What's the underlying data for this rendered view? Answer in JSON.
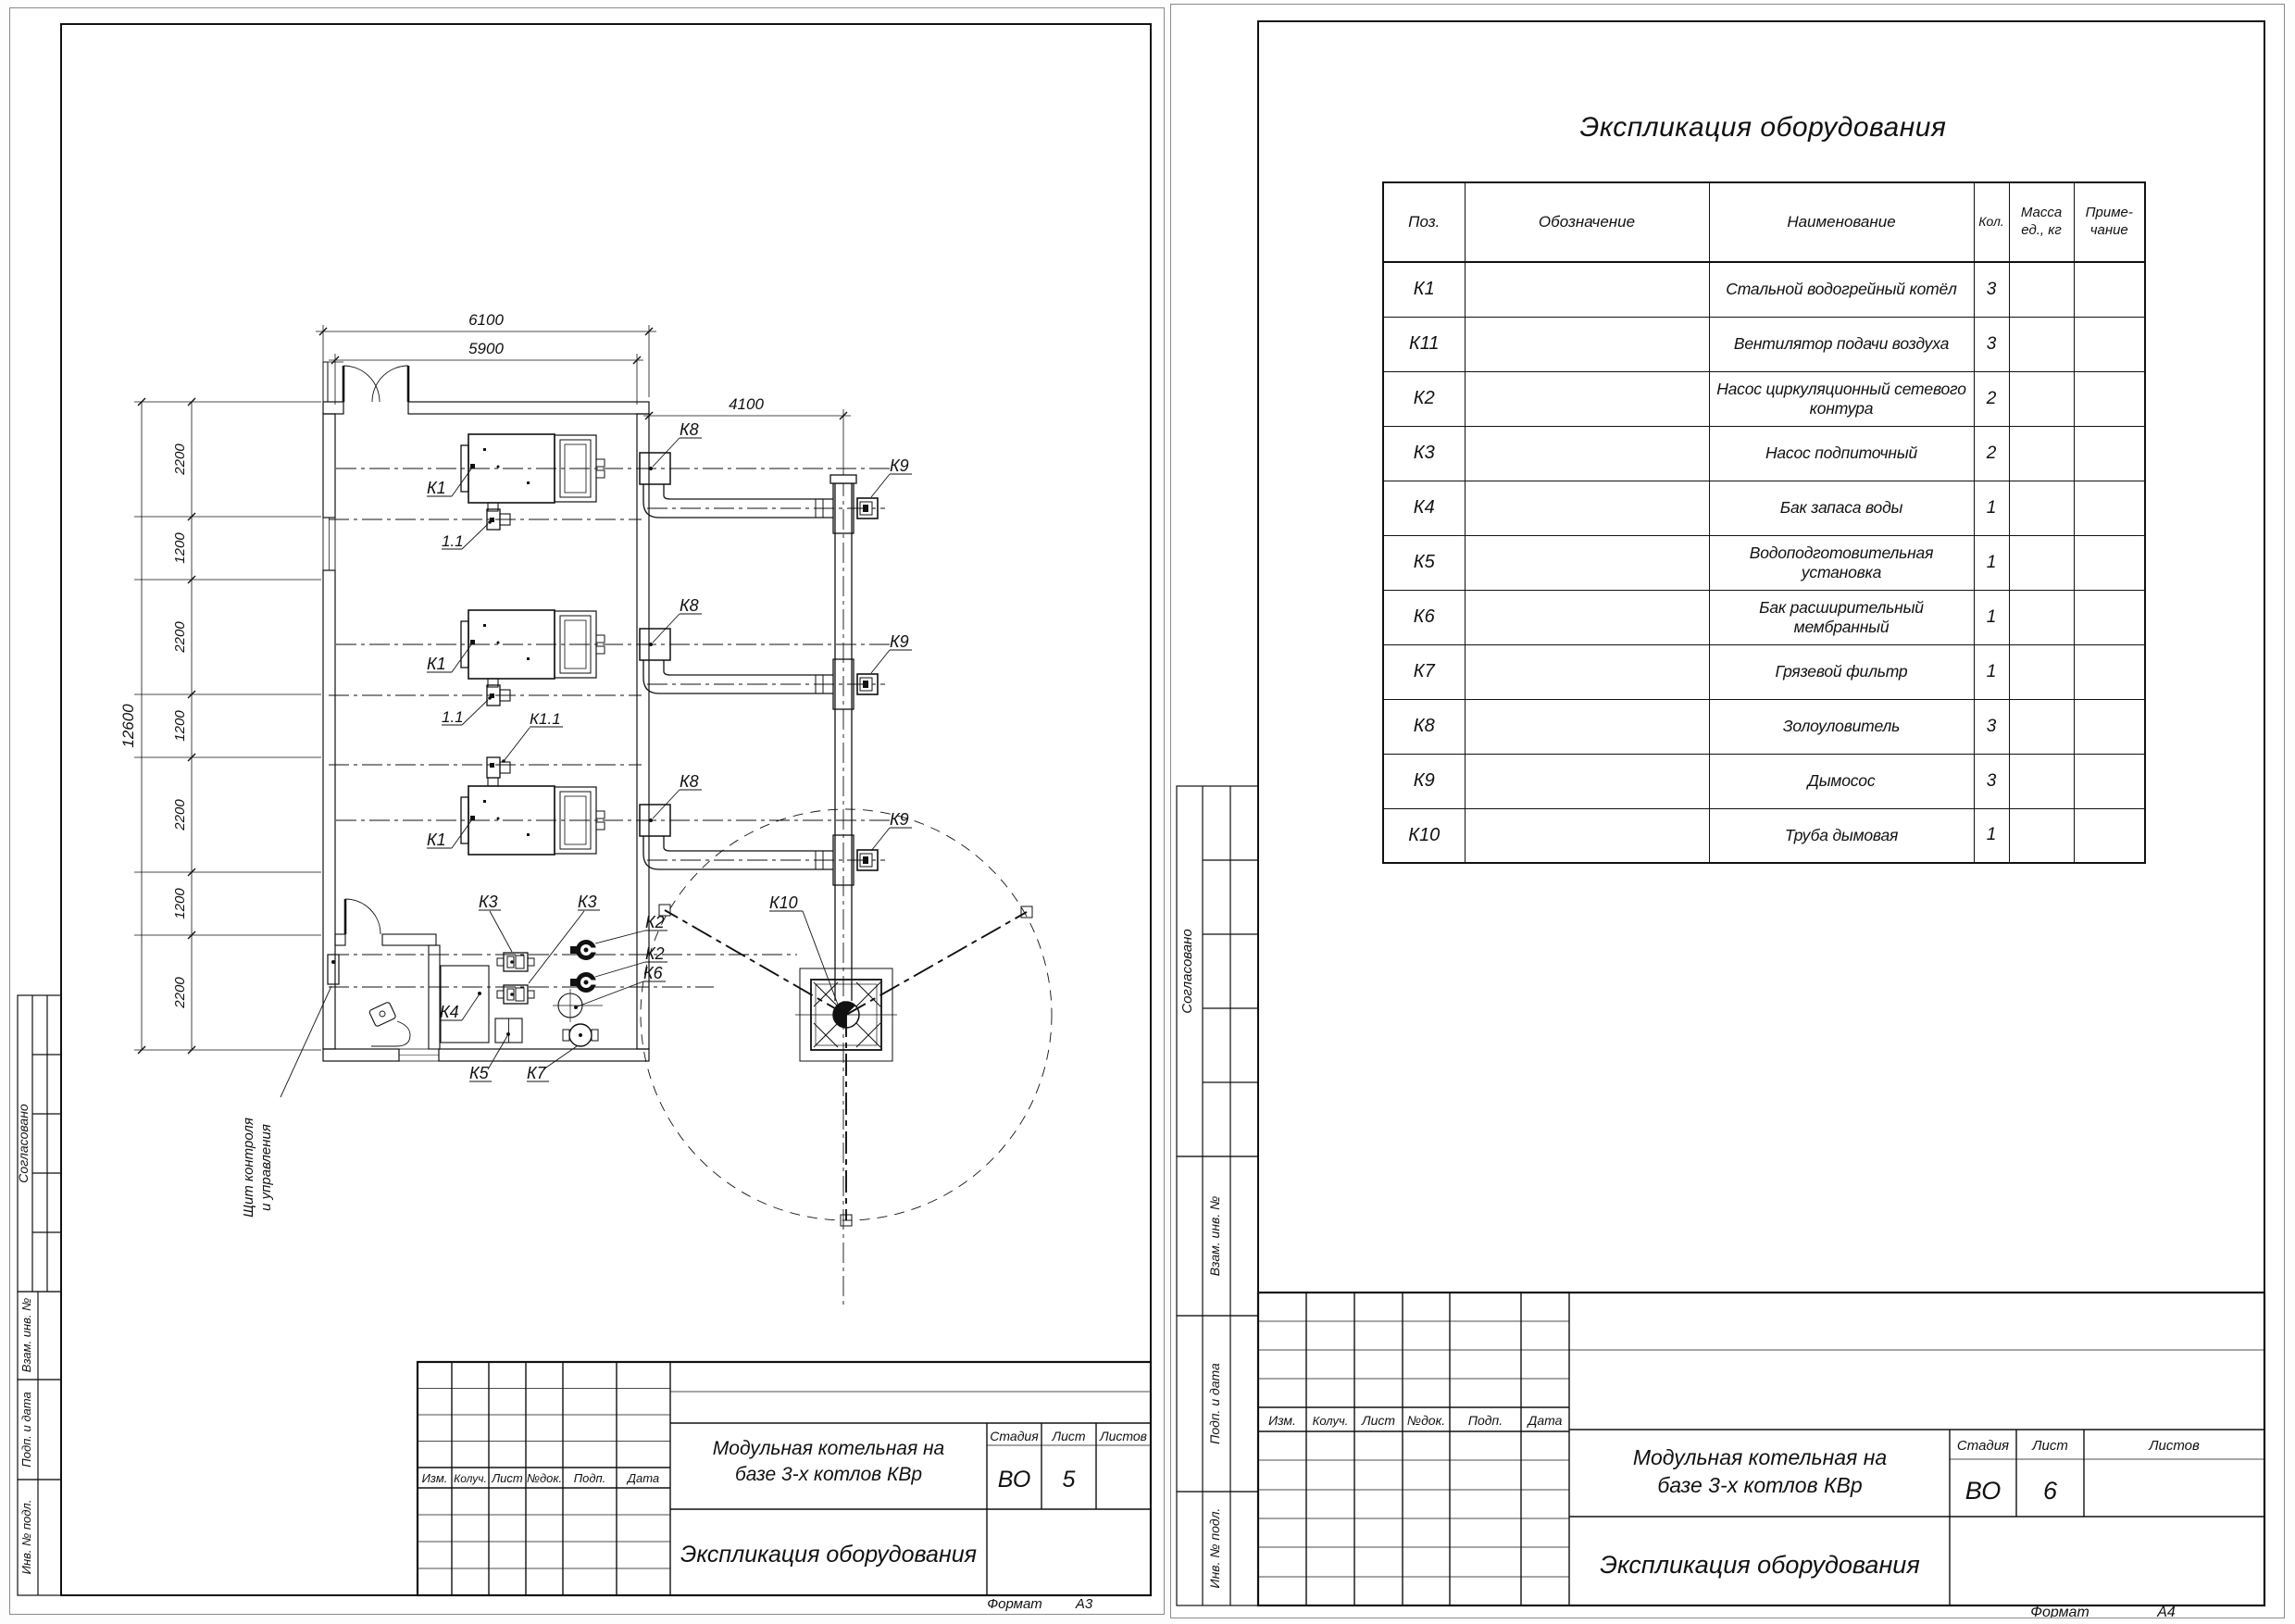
{
  "sheet_left": {
    "side_labels": [
      "Согласовано",
      "Взам. инв. №",
      "Подп. и дата",
      "Инв. № подл."
    ],
    "plan": {
      "dims": {
        "outer_width": "6100",
        "inner_width": "5900",
        "duct_span": "4100",
        "total_height": "12600",
        "segments": [
          "2200",
          "1200",
          "2200",
          "1200",
          "2200",
          "1200",
          "2200"
        ]
      },
      "labels": {
        "boiler": "К1",
        "fan": "1.1",
        "fan_k": "К1.1",
        "ash_collector": "К8",
        "smoke_exhauster": "К9",
        "chimney": "К10",
        "pump_network": "К2",
        "pump_feed": "К3",
        "tank": "К4",
        "water_treatment": "К5",
        "expansion_tank": "К6",
        "dirt_filter": "К7"
      },
      "panel_label": {
        "line1": "Щит контроля",
        "line2": "и управления"
      }
    },
    "stamp": {
      "rev": [
        "Изм.",
        "Колуч.",
        "Лист",
        "№док.",
        "Подп.",
        "Дата"
      ],
      "name_line1": "Модульная котельная на",
      "name_line2": "базе 3-х котлов КВр",
      "doc_title": "Экспликация оборудования",
      "stage_label": "Стадия",
      "stage": "ВО",
      "sheet_label": "Лист",
      "sheet": "5",
      "sheets_label": "Листов",
      "sheets": "",
      "format_label": "Формат",
      "format": "А3"
    }
  },
  "sheet_right": {
    "title": "Экспликация оборудования",
    "table": {
      "headers": {
        "pos": "Поз.",
        "designation": "Обозначение",
        "name": "Наименование",
        "qty": "Кол.",
        "mass": "Масса\nед., кг",
        "note": "Приме-\nчание"
      },
      "rows": [
        {
          "pos": "К1",
          "name": "Стальной водогрейный котёл",
          "qty": "3"
        },
        {
          "pos": "К11",
          "name": "Вентилятор подачи воздуха",
          "qty": "3"
        },
        {
          "pos": "К2",
          "name": "Насос циркуляционный сетевого контура",
          "qty": "2"
        },
        {
          "pos": "К3",
          "name": "Насос подпиточный",
          "qty": "2"
        },
        {
          "pos": "К4",
          "name": "Бак запаса воды",
          "qty": "1"
        },
        {
          "pos": "К5",
          "name": "Водоподготовительная установка",
          "qty": "1"
        },
        {
          "pos": "К6",
          "name": "Бак расширительный мембранный",
          "qty": "1"
        },
        {
          "pos": "К7",
          "name": "Грязевой фильтр",
          "qty": "1"
        },
        {
          "pos": "К8",
          "name": "Золоуловитель",
          "qty": "3"
        },
        {
          "pos": "К9",
          "name": "Дымосос",
          "qty": "3"
        },
        {
          "pos": "К10",
          "name": "Труба дымовая",
          "qty": "1"
        }
      ]
    },
    "side_labels": [
      "Согласовано",
      "Взам. инв. №",
      "Подп. и дата",
      "Инв. № подл."
    ],
    "stamp": {
      "rev": [
        "Изм.",
        "Колуч.",
        "Лист",
        "№док.",
        "Подп.",
        "Дата"
      ],
      "name_line1": "Модульная котельная на",
      "name_line2": "базе 3-х котлов КВр",
      "doc_title": "Экспликация оборудования",
      "stage_label": "Стадия",
      "stage": "ВО",
      "sheet_label": "Лист",
      "sheet": "6",
      "sheets_label": "Листов",
      "sheets": "",
      "format_label": "Формат",
      "format": "А4"
    }
  }
}
